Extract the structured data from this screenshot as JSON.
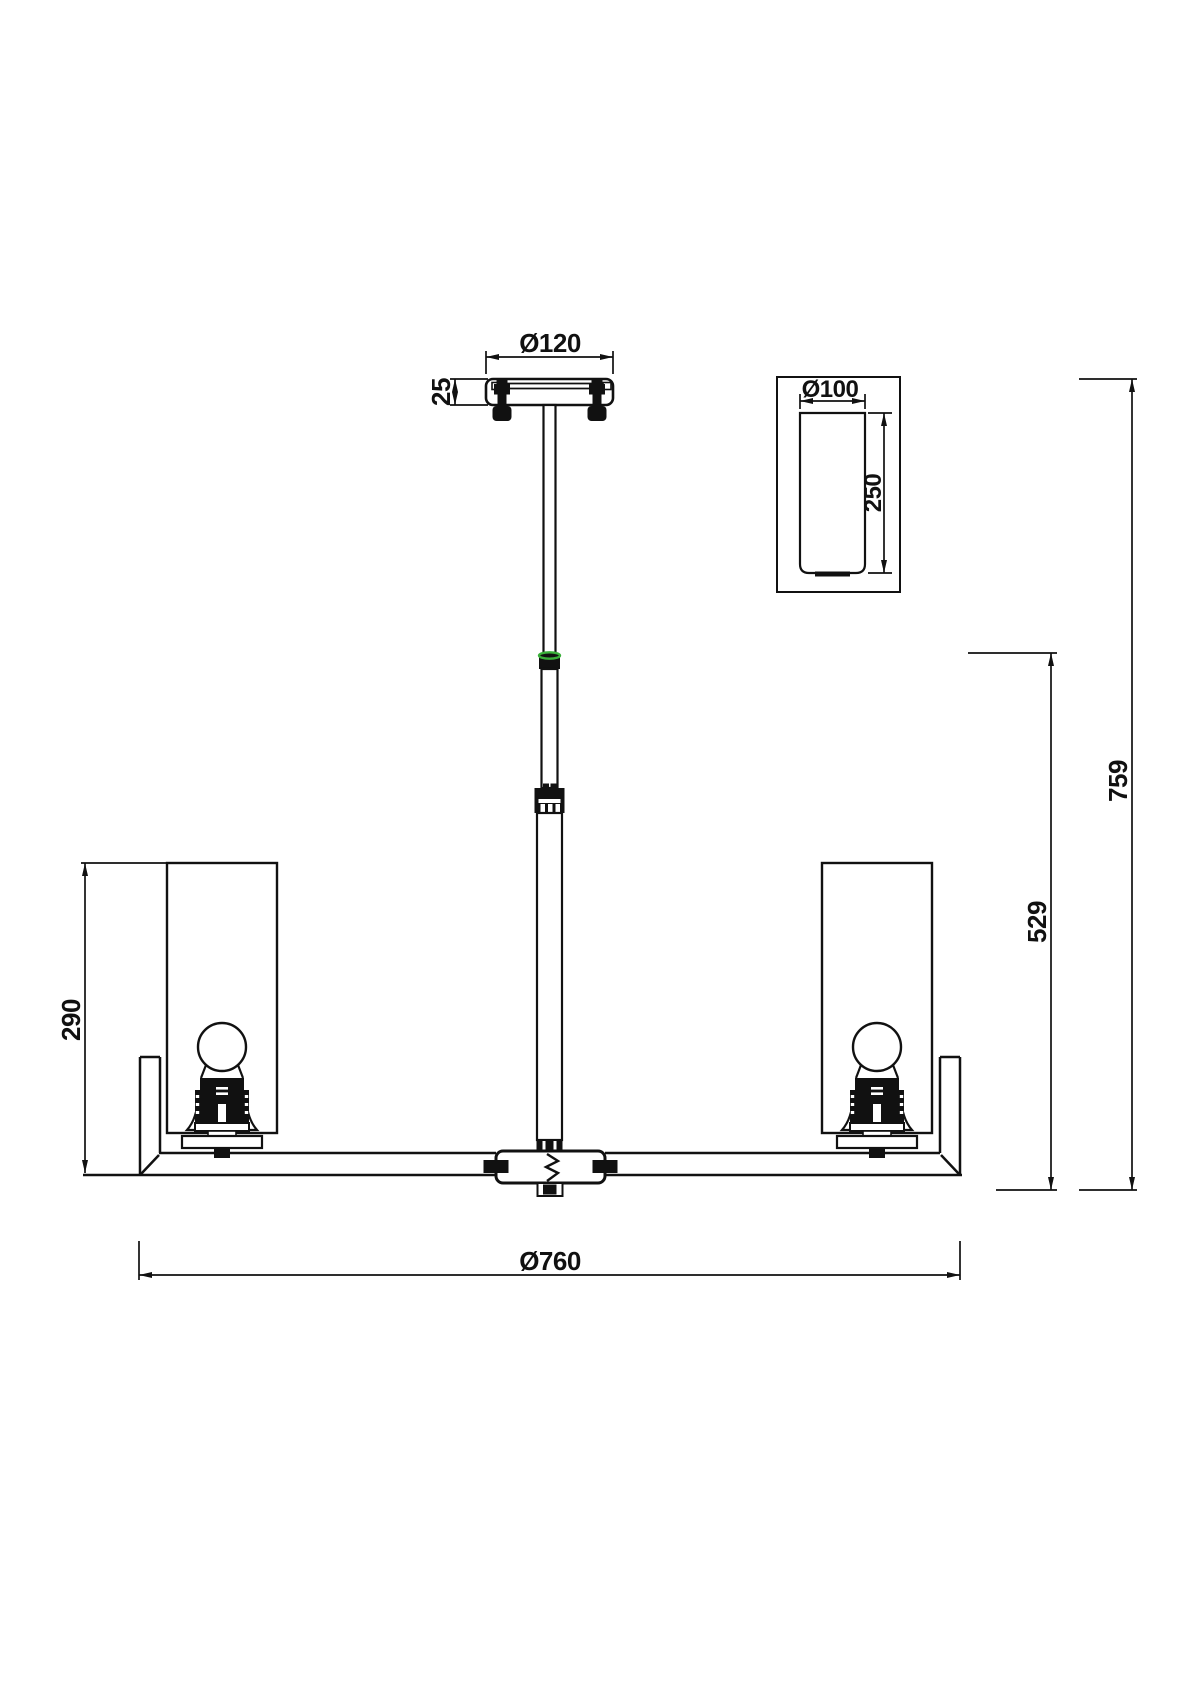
{
  "dimensions": {
    "canopy": {
      "diameter": "Ø120",
      "height": "25"
    },
    "overall": {
      "height": "759",
      "diameter": "Ø760"
    },
    "suspension": {
      "below_joint_height": "529"
    },
    "shade_zone": {
      "height": "290"
    },
    "detail": {
      "shade_diameter": "Ø100",
      "shade_height": "250"
    }
  },
  "colors": {
    "ink": "#111111",
    "paper": "#ffffff",
    "joint_highlight_green": "#3aaf3a"
  }
}
